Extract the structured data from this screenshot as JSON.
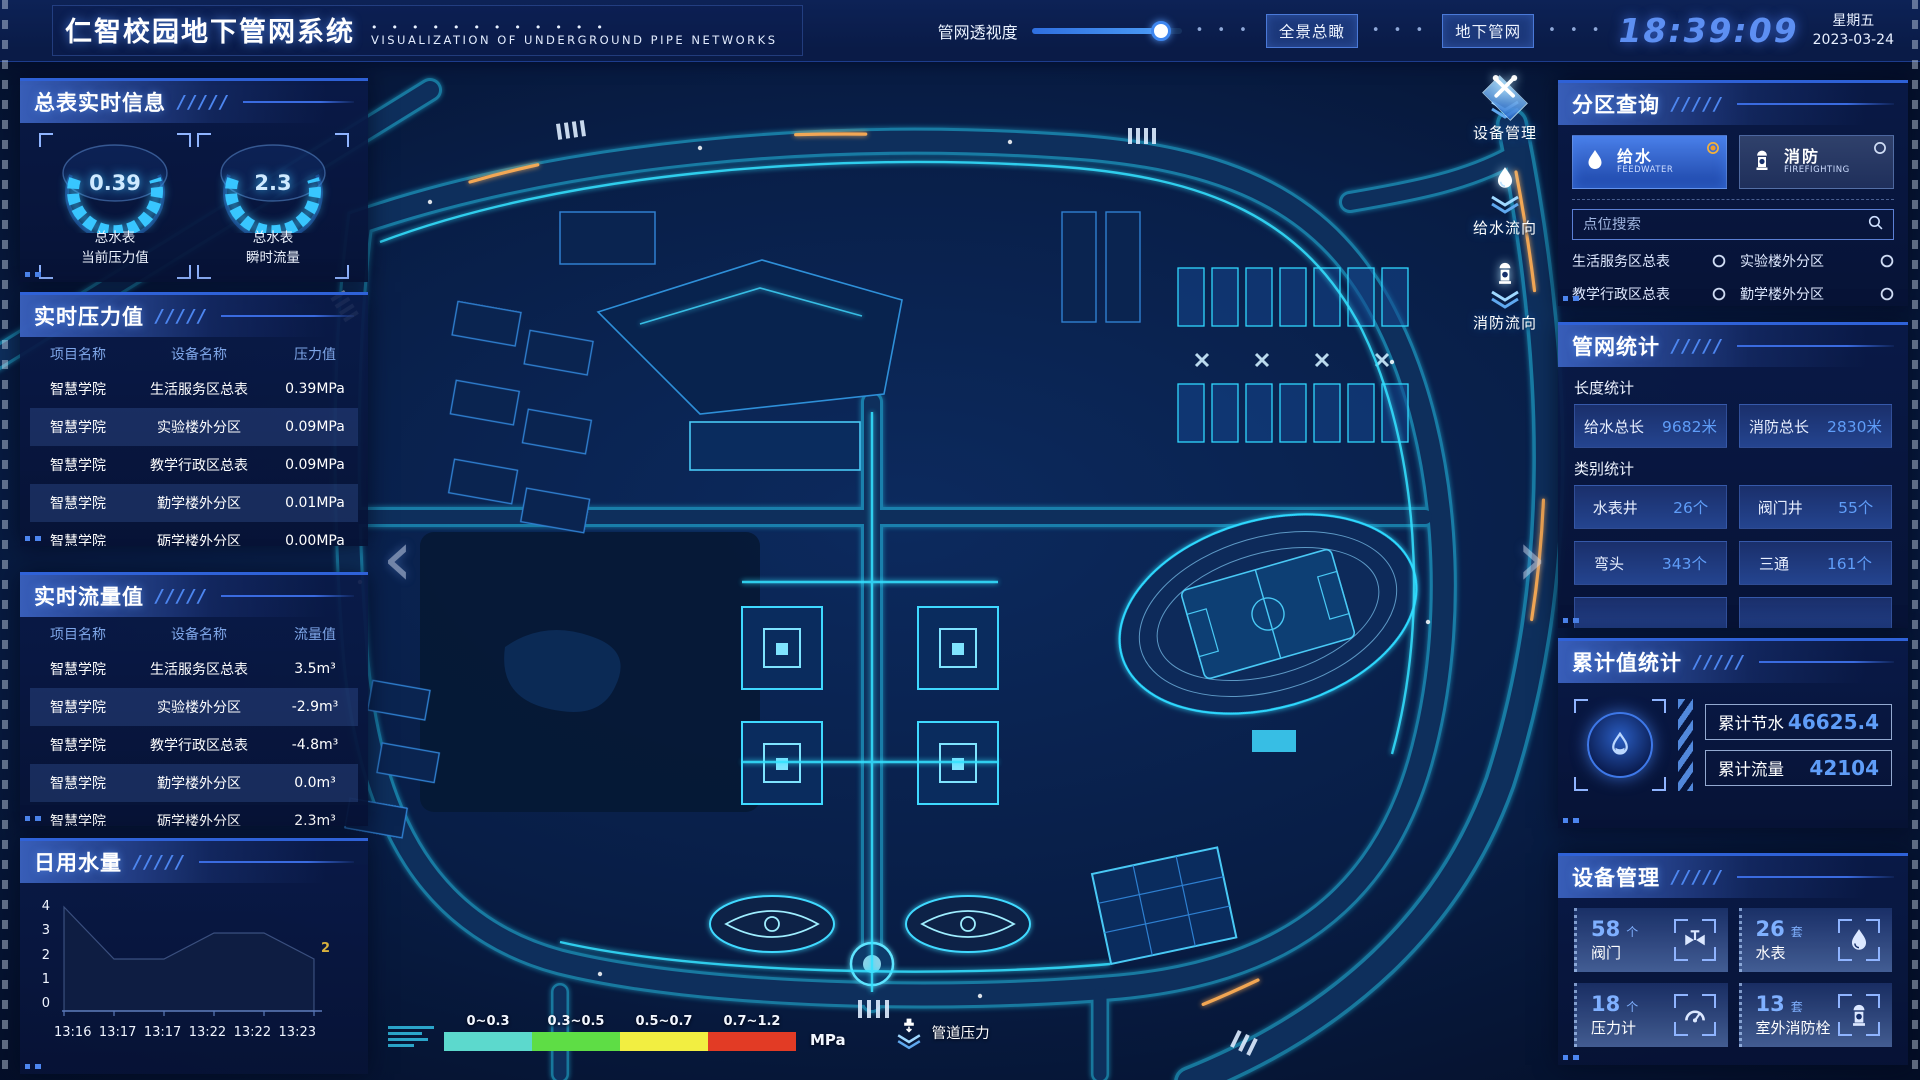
{
  "header": {
    "title": "仁智校园地下管网系统",
    "subtitle": "VISUALIZATION OF UNDERGROUND PIPE NETWORKS",
    "opacity_label": "管网透视度",
    "slider_fill": "86%",
    "buttons": [
      {
        "label": "全景总瞰"
      },
      {
        "label": "地下管网"
      }
    ],
    "clock": "18:39:09",
    "weekday": "星期五",
    "date": "2023-03-24"
  },
  "left": {
    "realtime_info": {
      "title": "总表实时信息",
      "gauges": [
        {
          "value": "0.39",
          "line1": "总水表",
          "line2": "当前压力值"
        },
        {
          "value": "2.3",
          "line1": "总水表",
          "line2": "瞬时流量"
        }
      ]
    },
    "pressure": {
      "title": "实时压力值",
      "columns": [
        "项目名称",
        "设备名称",
        "压力值"
      ],
      "rows": [
        [
          "智慧学院",
          "生活服务区总表",
          "0.39MPa"
        ],
        [
          "智慧学院",
          "实验楼外分区",
          "0.09MPa"
        ],
        [
          "智慧学院",
          "教学行政区总表",
          "0.09MPa"
        ],
        [
          "智慧学院",
          "勤学楼外分区",
          "0.01MPa"
        ],
        [
          "智慧学院",
          "砺学楼外分区",
          "0.00MPa"
        ]
      ]
    },
    "flow": {
      "title": "实时流量值",
      "columns": [
        "项目名称",
        "设备名称",
        "流量值"
      ],
      "rows": [
        [
          "智慧学院",
          "生活服务区总表",
          "3.5m³"
        ],
        [
          "智慧学院",
          "实验楼外分区",
          "-2.9m³"
        ],
        [
          "智慧学院",
          "教学行政区总表",
          "-4.8m³"
        ],
        [
          "智慧学院",
          "勤学楼外分区",
          "0.0m³"
        ],
        [
          "智慧学院",
          "砺学楼外分区",
          "2.3m³"
        ]
      ]
    },
    "daily_water": {
      "title": "日用水量",
      "chart_data": {
        "type": "area",
        "title": "日用水量",
        "x": [
          "13:16",
          "13:17",
          "13:17",
          "13:22",
          "13:22",
          "13:23"
        ],
        "values": [
          4,
          2,
          2,
          3,
          3,
          2
        ],
        "y_ticks": [
          "4",
          "3",
          "2",
          "1",
          "0"
        ],
        "ylim": [
          0,
          4
        ],
        "end_label": "2"
      }
    }
  },
  "map": {
    "nav_left": "‹",
    "nav_right": "›",
    "tools": [
      {
        "label": "设备管理",
        "icon": "wrench-icon"
      },
      {
        "label": "给水流向",
        "icon": "water-drop-icon"
      },
      {
        "label": "消防流向",
        "icon": "hydrant-icon"
      }
    ],
    "legend": {
      "ranges": [
        {
          "label": "0~0.3",
          "color": "#5cd9cd"
        },
        {
          "label": "0.3~0.5",
          "color": "#5edd45"
        },
        {
          "label": "0.5~0.7",
          "color": "#f2ee41"
        },
        {
          "label": "0.7~1.2",
          "color": "#e23b25"
        }
      ],
      "unit": "MPa",
      "label": "管道压力"
    }
  },
  "right": {
    "zone_query": {
      "title": "分区查询",
      "tabs": [
        {
          "label": "给水",
          "sub": "FEEDWATER",
          "selected": true
        },
        {
          "label": "消防",
          "sub": "FIREFIGHTING",
          "selected": false
        }
      ],
      "search_placeholder": "点位搜索",
      "items": [
        "生活服务区总表",
        "实验楼外分区",
        "教学行政区总表",
        "勤学楼外分区",
        "砺学楼外分区",
        "宿舍区泵房"
      ]
    },
    "pipe_stats": {
      "title": "管网统计",
      "length_title": "长度统计",
      "length_stats": [
        {
          "label": "给水总长",
          "value": "9682米"
        },
        {
          "label": "消防总长",
          "value": "2830米"
        }
      ],
      "category_title": "类别统计",
      "category_stats": [
        {
          "label": "水表井",
          "value": "26个"
        },
        {
          "label": "阀门井",
          "value": "55个"
        },
        {
          "label": "弯头",
          "value": "343个"
        },
        {
          "label": "三通",
          "value": "161个"
        }
      ]
    },
    "cumulative": {
      "title": "累计值统计",
      "stats": [
        {
          "label": "累计节水",
          "value": "46625.4"
        },
        {
          "label": "累计流量",
          "value": "42104"
        }
      ]
    },
    "devices": {
      "title": "设备管理",
      "cards": [
        {
          "count": "58",
          "unit": "个",
          "label": "阀门",
          "icon": "valve-icon"
        },
        {
          "count": "26",
          "unit": "套",
          "label": "水表",
          "icon": "water-meter-icon"
        },
        {
          "count": "18",
          "unit": "个",
          "label": "压力计",
          "icon": "pressure-gauge-icon"
        },
        {
          "count": "13",
          "unit": "套",
          "label": "室外消防栓",
          "icon": "hydrant-icon"
        }
      ]
    }
  }
}
